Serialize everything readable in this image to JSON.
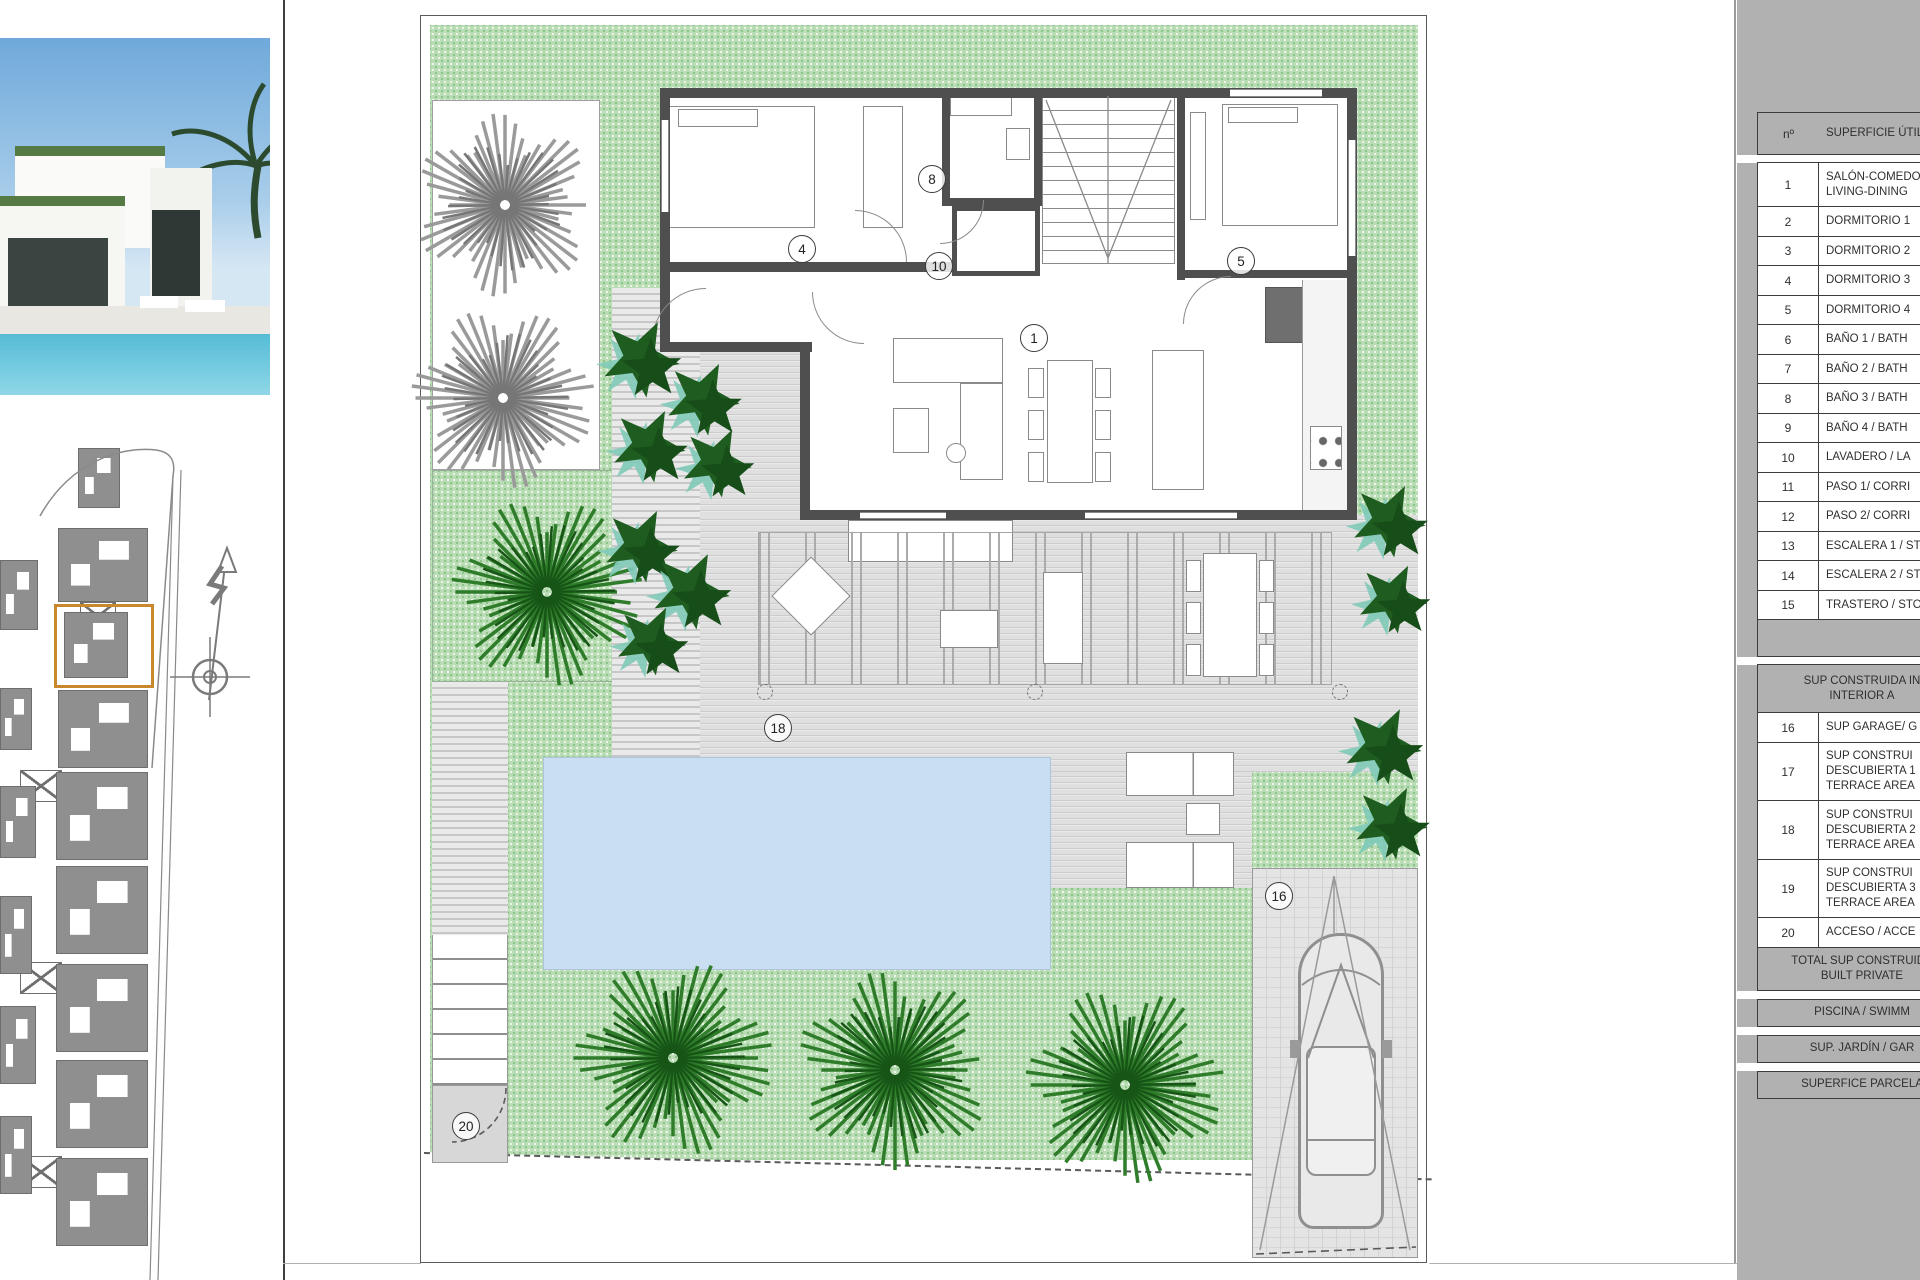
{
  "sheet": {
    "type": "villa-ground-floor-plan"
  },
  "colors": {
    "accent_orange": "#C8882B",
    "garden_green": "#B9DCB4",
    "pool_blue": "#C9DEF1",
    "deck_gray": "#D9D9D9",
    "wall_gray": "#4F4F4F",
    "panel_gray": "#B1B1B1",
    "bush_green": "#1E5C20",
    "palm_green": "#2F7D2B",
    "tree_gray": "#9A9A9A",
    "teal_accent": "#7FCAB8"
  },
  "sidebar": {
    "photo": {
      "name": "villa-exterior-render"
    },
    "site_plan": {
      "compass": "north-arrow",
      "highlight_color": "#C8882B",
      "blocks": [
        {
          "x": 78,
          "y": 448,
          "w": 40,
          "h": 58
        },
        {
          "x": 58,
          "y": 528,
          "w": 88,
          "h": 72
        },
        {
          "x": 80,
          "y": 602,
          "w": 34,
          "h": 26,
          "cross": true
        },
        {
          "x": 64,
          "y": 612,
          "w": 62,
          "h": 64
        },
        {
          "x": 58,
          "y": 690,
          "w": 88,
          "h": 76
        },
        {
          "x": 20,
          "y": 770,
          "w": 40,
          "h": 30,
          "cross": true
        },
        {
          "x": 56,
          "y": 772,
          "w": 90,
          "h": 86
        },
        {
          "x": 56,
          "y": 866,
          "w": 90,
          "h": 86
        },
        {
          "x": 20,
          "y": 962,
          "w": 40,
          "h": 30,
          "cross": true
        },
        {
          "x": 56,
          "y": 964,
          "w": 90,
          "h": 86
        },
        {
          "x": 56,
          "y": 1060,
          "w": 90,
          "h": 86
        },
        {
          "x": 20,
          "y": 1156,
          "w": 40,
          "h": 30,
          "cross": true
        },
        {
          "x": 56,
          "y": 1158,
          "w": 90,
          "h": 86
        },
        {
          "x": 0,
          "y": 560,
          "w": 36,
          "h": 68
        },
        {
          "x": 0,
          "y": 688,
          "w": 30,
          "h": 60
        },
        {
          "x": 0,
          "y": 786,
          "w": 34,
          "h": 70
        },
        {
          "x": 0,
          "y": 896,
          "w": 30,
          "h": 76
        },
        {
          "x": 0,
          "y": 1006,
          "w": 34,
          "h": 76
        },
        {
          "x": 0,
          "y": 1116,
          "w": 30,
          "h": 76
        }
      ]
    }
  },
  "floor_plan": {
    "labels": [
      {
        "n": "1",
        "x": 1033,
        "y": 337
      },
      {
        "n": "4",
        "x": 801,
        "y": 248
      },
      {
        "n": "5",
        "x": 1240,
        "y": 260
      },
      {
        "n": "8",
        "x": 931,
        "y": 178
      },
      {
        "n": "10",
        "x": 938,
        "y": 265
      },
      {
        "n": "16",
        "x": 1278,
        "y": 895
      },
      {
        "n": "18",
        "x": 777,
        "y": 727
      },
      {
        "n": "20",
        "x": 465,
        "y": 1125
      }
    ],
    "vegetation": {
      "gray_trees": [
        {
          "x": 505,
          "y": 205,
          "r": 92
        },
        {
          "x": 503,
          "y": 398,
          "r": 92
        }
      ],
      "green_palms": [
        {
          "x": 547,
          "y": 592,
          "r": 96
        },
        {
          "x": 673,
          "y": 1058,
          "r": 100
        },
        {
          "x": 895,
          "y": 1070,
          "r": 100
        },
        {
          "x": 1125,
          "y": 1085,
          "r": 100
        }
      ],
      "bushes": [
        {
          "x": 640,
          "y": 358,
          "r": 40
        },
        {
          "x": 702,
          "y": 398,
          "r": 38
        },
        {
          "x": 648,
          "y": 445,
          "r": 38
        },
        {
          "x": 716,
          "y": 462,
          "r": 36
        },
        {
          "x": 640,
          "y": 545,
          "r": 38
        },
        {
          "x": 690,
          "y": 590,
          "r": 40
        },
        {
          "x": 650,
          "y": 640,
          "r": 36
        },
        {
          "x": 1388,
          "y": 520,
          "r": 38
        },
        {
          "x": 1392,
          "y": 598,
          "r": 36
        },
        {
          "x": 1382,
          "y": 745,
          "r": 40
        },
        {
          "x": 1390,
          "y": 822,
          "r": 38
        }
      ]
    }
  },
  "table": {
    "header_num": "nº",
    "header_label": "SUPERFICIE ÚTIL",
    "rows": [
      {
        "n": "1",
        "lines": [
          "SALÓN-COMEDOR",
          "LIVING-DINING"
        ]
      },
      {
        "n": "2",
        "lines": [
          "DORMITORIO 1"
        ]
      },
      {
        "n": "3",
        "lines": [
          "DORMITORIO 2"
        ]
      },
      {
        "n": "4",
        "lines": [
          "DORMITORIO 3"
        ]
      },
      {
        "n": "5",
        "lines": [
          "DORMITORIO 4"
        ]
      },
      {
        "n": "6",
        "lines": [
          "BAÑO 1 / BATH"
        ]
      },
      {
        "n": "7",
        "lines": [
          "BAÑO 2 / BATH"
        ]
      },
      {
        "n": "8",
        "lines": [
          "BAÑO 3 / BATH"
        ]
      },
      {
        "n": "9",
        "lines": [
          "BAÑO 4 / BATH"
        ]
      },
      {
        "n": "10",
        "lines": [
          "LAVADERO / LA"
        ]
      },
      {
        "n": "11",
        "lines": [
          "PASO 1/ CORRI"
        ]
      },
      {
        "n": "12",
        "lines": [
          "PASO 2/ CORRI"
        ]
      },
      {
        "n": "13",
        "lines": [
          "ESCALERA 1 / ST"
        ]
      },
      {
        "n": "14",
        "lines": [
          "ESCALERA 2 / ST"
        ]
      },
      {
        "n": "15",
        "lines": [
          "TRASTERO / STO"
        ]
      }
    ],
    "section2": {
      "header_lines": [
        "SUP CONSTRUIDA IN",
        "INTERIOR A"
      ],
      "rows": [
        {
          "n": "16",
          "lines": [
            "SUP GARAGE/ G"
          ]
        },
        {
          "n": "17",
          "lines": [
            "SUP CONSTRUI",
            "DESCUBIERTA 1",
            "TERRACE AREA"
          ]
        },
        {
          "n": "18",
          "lines": [
            "SUP CONSTRUI",
            "DESCUBIERTA 2",
            "TERRACE AREA"
          ]
        },
        {
          "n": "19",
          "lines": [
            "SUP CONSTRUI",
            "DESCUBIERTA 3",
            "TERRACE AREA"
          ]
        },
        {
          "n": "20",
          "lines": [
            "ACCESO / ACCE"
          ]
        }
      ]
    },
    "total_lines": [
      "TOTAL SUP CONSTRUIDA",
      "BUILT PRIVATE"
    ],
    "bars": [
      "PISCINA / SWIMM",
      "SUP. JARDÍN / GAR",
      "SUPERFICE PARCELA"
    ]
  }
}
